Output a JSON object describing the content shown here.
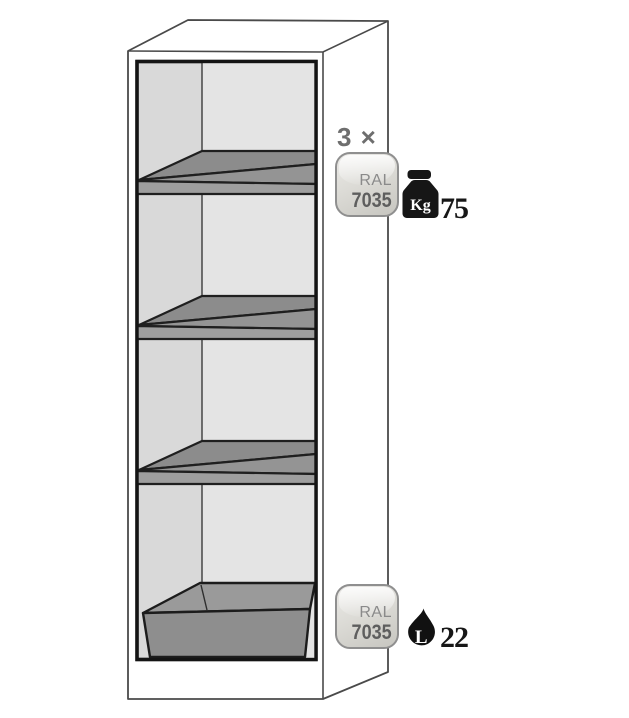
{
  "diagram": {
    "subject": "safety-cabinet-cutaway-illustration",
    "compartments": 4,
    "shelves_shown": 3,
    "sump_tray_shown": 1
  },
  "callouts": {
    "shelves": {
      "count": "3 ×",
      "ral_badge": {
        "line1": "RAL",
        "line2": "7035"
      },
      "max_load": {
        "unit": "Kg",
        "value": "75"
      }
    },
    "sump": {
      "ral_badge": {
        "line1": "RAL",
        "line2": "7035"
      },
      "capacity": {
        "unit": "L",
        "value": "22"
      }
    }
  },
  "icons": {
    "max_load": "kettlebell-weight-icon",
    "capacity": "liquid-drop-icon"
  },
  "colors": {
    "cabinet_outline": "#4a4a4a",
    "opening_border": "#141414",
    "interior_left_wall": "#d9d9d9",
    "interior_back_wall": "#e4e4e4",
    "shelf_top": "#8c8c8c",
    "shelf_rim": "#949494",
    "shelf_front": "#9e9e9e",
    "sump_top": "#9a9a9a",
    "sump_front": "#8e8e8e",
    "badge_border": "#8f8f8f",
    "badge_fill_light": "#ebeae7",
    "badge_fill_dark": "#c7c6c0",
    "badge_text": "#5e5e5e",
    "count_text": "#6e6e6e",
    "value_text": "#171717",
    "icon_black": "#161616"
  }
}
